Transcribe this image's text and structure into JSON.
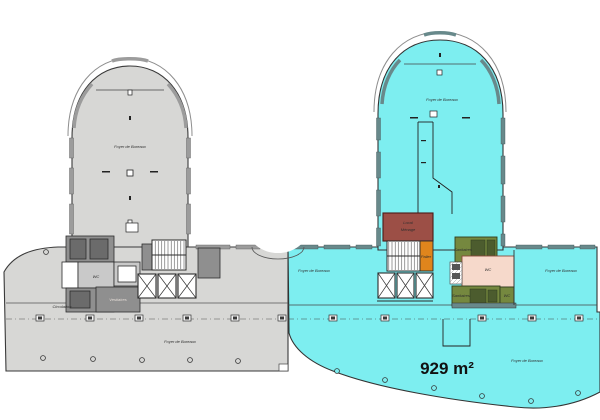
{
  "colors": {
    "background": "#ffffff",
    "left_fill": "#d7d7d5",
    "left_dark_room": "#8f8f8f",
    "left_darker_room": "#6b6b6b",
    "left_light_room": "#c9c9c9",
    "window_band_gray": "#9c9c9c",
    "right_fill": "#7deef0",
    "window_band_cyan": "#68898b",
    "maroon_room": "#9c4f46",
    "orange_room": "#e0851c",
    "olive_room": "#75883f",
    "olive_dark": "#4c5c2e",
    "pink_room": "#f6d9cb",
    "outline": "#3a3a3a",
    "text": "#1a1a1a"
  },
  "area": {
    "value": "929 m²"
  },
  "labels": {
    "tower_left": "Foyer de Bureaux",
    "wing_left": "Foyer de Bureaux",
    "wing_left_small": "Circulation",
    "light_room_left": "WC",
    "dark_band_left": "Vestiaires",
    "tower_right": "Foyer de Bureaux",
    "band_left": "Foyer de Bureaux",
    "band_right": "Foyer de Bureaux",
    "open_area": "Foyer de Bureaux",
    "maroon_1": "Local",
    "maroon_2": "Ménage",
    "orange": "Palier",
    "green_top": "Sanitaires",
    "green_bottom": "Sanitaires",
    "green_small": "WC",
    "pink": "WC"
  }
}
